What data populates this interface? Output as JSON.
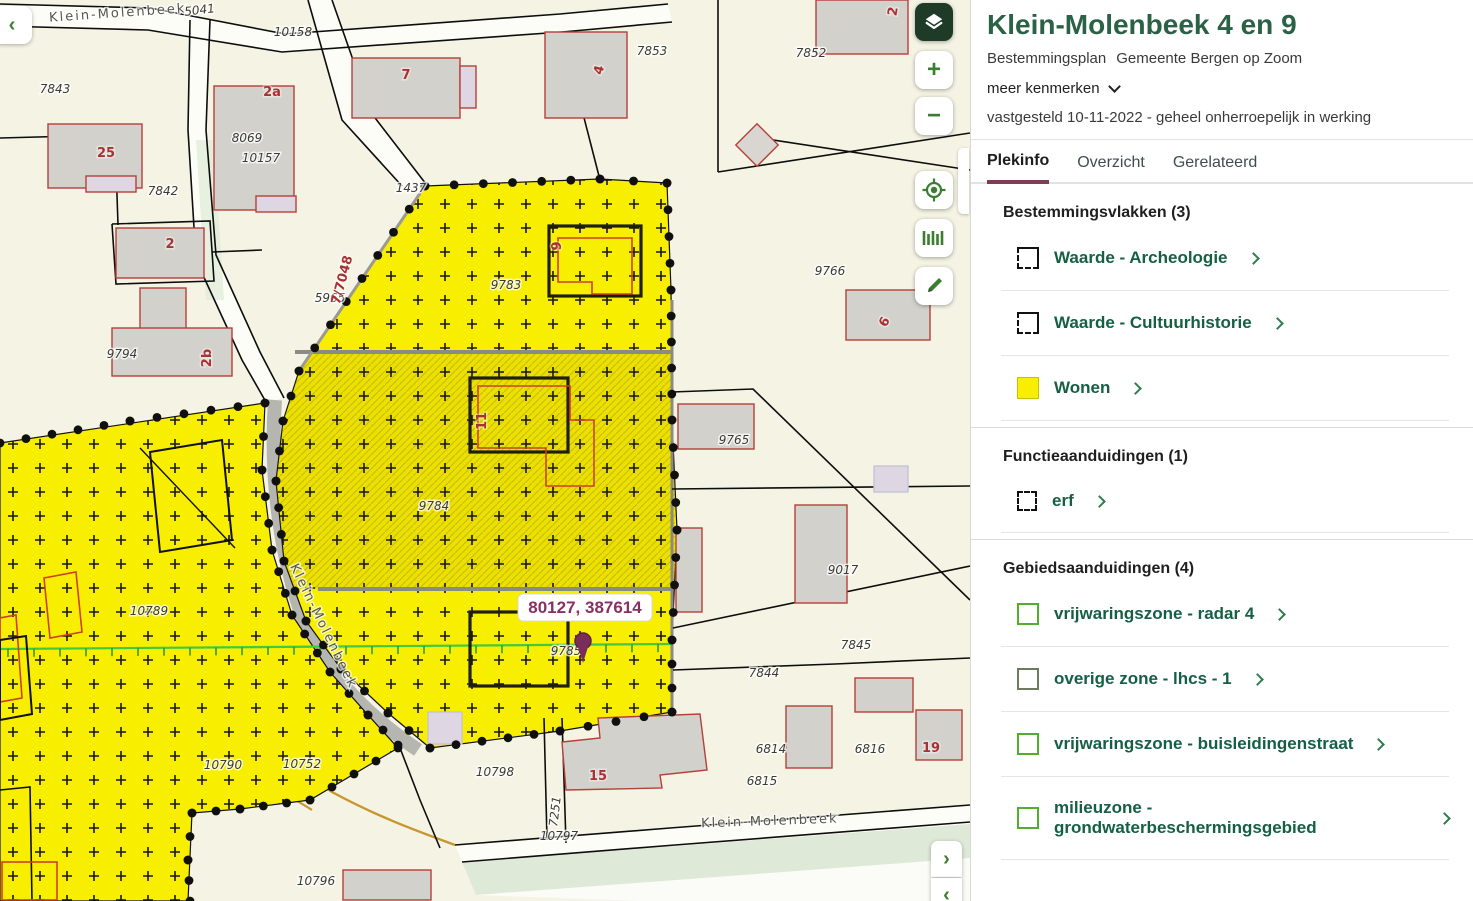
{
  "panel": {
    "title": "Klein-Molenbeek 4 en 9",
    "subtitle_type": "Bestemmingsplan",
    "subtitle_org": "Gemeente Bergen op Zoom",
    "more_label": "meer kenmerken",
    "status_line": "vastgesteld 10-11-2022 - geheel onherroepelijk in werking",
    "tabs": [
      {
        "label": "Plekinfo",
        "active": true
      },
      {
        "label": "Overzicht",
        "active": false
      },
      {
        "label": "Gerelateerd",
        "active": false
      }
    ],
    "sections": [
      {
        "heading": "Bestemmingsvlakken (3)",
        "items": [
          {
            "label": "Waarde - Archeologie",
            "icon": "waarde-square-icon"
          },
          {
            "label": "Waarde - Cultuurhistorie",
            "icon": "waarde-square-icon"
          },
          {
            "label": "Wonen",
            "icon": "wonen-yellow-square-icon"
          }
        ]
      },
      {
        "heading": "Functieaanduidingen (1)",
        "items": [
          {
            "label": "erf",
            "icon": "dashed-square-icon"
          }
        ]
      },
      {
        "heading": "Gebiedsaanduidingen (4)",
        "items": [
          {
            "label": "vrijwaringszone - radar 4",
            "icon": "green-square-icon"
          },
          {
            "label": "overige zone - lhcs - 1",
            "icon": "olive-square-icon"
          },
          {
            "label": "vrijwaringszone - buisleidingenstraat",
            "icon": "green-square-icon"
          },
          {
            "label": "milieuzone - grondwaterbeschermingsgebied",
            "icon": "green-square-icon"
          }
        ]
      }
    ]
  },
  "map": {
    "controls": {
      "back": "‹",
      "zoom_in": "+",
      "zoom_out": "−",
      "expand": "›",
      "collapse": "‹",
      "icon_names": [
        "layers-icon",
        "zoom-in",
        "zoom-out",
        "locate-icon",
        "measure-icon",
        "pencil-icon"
      ]
    },
    "coordinate_label": "80127, 387614",
    "labels": [
      {
        "t": "5041",
        "x": 200,
        "y": 14,
        "r": -7
      },
      {
        "t": "10158",
        "x": 293,
        "y": 36
      },
      {
        "t": "7843",
        "x": 55,
        "y": 93
      },
      {
        "t": "7842",
        "x": 163,
        "y": 195
      },
      {
        "t": "8069",
        "x": 247,
        "y": 142
      },
      {
        "t": "10157",
        "x": 261,
        "y": 162
      },
      {
        "t": "1437",
        "x": 411,
        "y": 192
      },
      {
        "t": "7853",
        "x": 652,
        "y": 55
      },
      {
        "t": "7852",
        "x": 811,
        "y": 57
      },
      {
        "t": "9794",
        "x": 122,
        "y": 358
      },
      {
        "t": "5965",
        "x": 330,
        "y": 302
      },
      {
        "t": "9783",
        "x": 506,
        "y": 289
      },
      {
        "t": "9766",
        "x": 830,
        "y": 275
      },
      {
        "t": "9765",
        "x": 734,
        "y": 444
      },
      {
        "t": "9784",
        "x": 434,
        "y": 510
      },
      {
        "t": "9017",
        "x": 843,
        "y": 574
      },
      {
        "t": "10789",
        "x": 149,
        "y": 615
      },
      {
        "t": "9785",
        "x": 566,
        "y": 655
      },
      {
        "t": "7845",
        "x": 856,
        "y": 649
      },
      {
        "t": "7844",
        "x": 764,
        "y": 677
      },
      {
        "t": "6814",
        "x": 771,
        "y": 753
      },
      {
        "t": "6816",
        "x": 870,
        "y": 753
      },
      {
        "t": "6815",
        "x": 762,
        "y": 785
      },
      {
        "t": "10790",
        "x": 223,
        "y": 769
      },
      {
        "t": "10752",
        "x": 302,
        "y": 768
      },
      {
        "t": "10798",
        "x": 495,
        "y": 776
      },
      {
        "t": "10797",
        "x": 559,
        "y": 840
      },
      {
        "t": "10796",
        "x": 316,
        "y": 885
      },
      {
        "t": "7251",
        "x": 559,
        "y": 812,
        "r": -83
      },
      {
        "t": "25",
        "x": 106,
        "y": 157,
        "k": "h"
      },
      {
        "t": "2",
        "x": 170,
        "y": 248,
        "k": "h"
      },
      {
        "t": "2a",
        "x": 272,
        "y": 96,
        "k": "h"
      },
      {
        "t": "2b",
        "x": 211,
        "y": 358,
        "k": "h",
        "r": -90
      },
      {
        "t": "7",
        "x": 406,
        "y": 79,
        "k": "h"
      },
      {
        "t": "4",
        "x": 603,
        "y": 71,
        "k": "h",
        "r": -75
      },
      {
        "t": "2",
        "x": 897,
        "y": 12,
        "k": "h",
        "r": -80
      },
      {
        "t": "6",
        "x": 888,
        "y": 324,
        "k": "h",
        "r": -60
      },
      {
        "t": "9",
        "x": 561,
        "y": 246,
        "k": "h",
        "r": -90
      },
      {
        "t": "11",
        "x": 486,
        "y": 421,
        "k": "h",
        "r": -90
      },
      {
        "t": "15",
        "x": 598,
        "y": 780,
        "k": "h"
      },
      {
        "t": "19",
        "x": 931,
        "y": 752,
        "k": "h"
      },
      {
        "t": "7/7048",
        "x": 346,
        "y": 281,
        "k": "h",
        "r": -75
      },
      {
        "t": "Klein-Molenbeek",
        "x": 770,
        "y": 825,
        "k": "s",
        "r": -2
      },
      {
        "t": "Klein-Molenbeek",
        "x": 320,
        "y": 628,
        "k": "s",
        "r": 64
      },
      {
        "t": "Klein-Molenbeek",
        "x": 118,
        "y": 17,
        "k": "s",
        "r": -4
      }
    ]
  },
  "colors": {
    "title_green": "#2b6145",
    "item_green": "#156045",
    "chevron_green": "#2e7d4f",
    "tab_underline": "#7c3d57",
    "control_green": "#3c7d2f",
    "layers_bg": "#1e3b27",
    "wonen_yellow": "#f8ee00",
    "zone_green": "#52ae2d",
    "zone_olive": "#6d7c60",
    "coord_purple": "#8a2f63",
    "map_background": "#f5f4e4"
  }
}
